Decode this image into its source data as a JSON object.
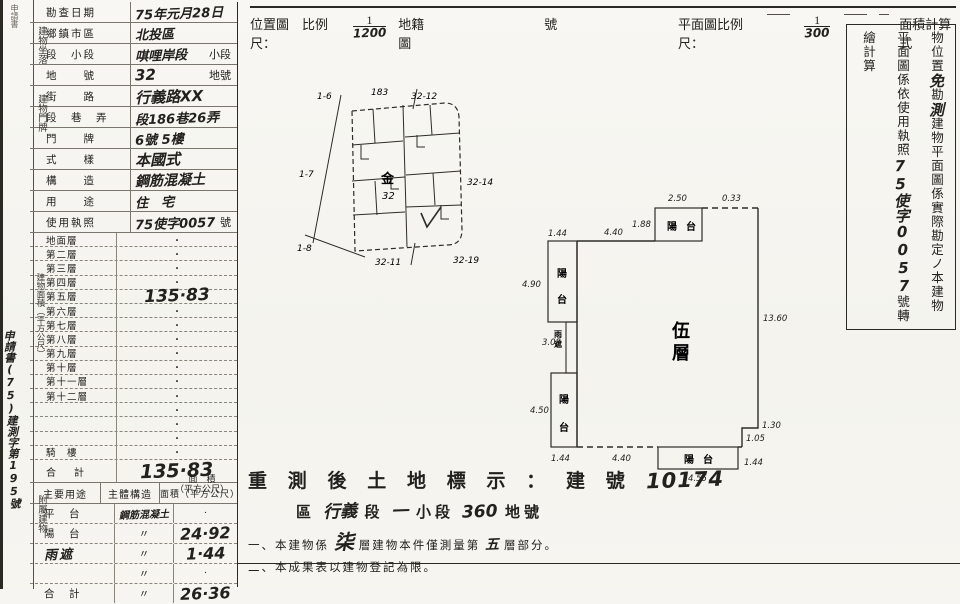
{
  "left_margin": {
    "top_label": "申請書",
    "doc_no": "申請書(75)建測字第195號"
  },
  "header": {
    "left_label": "位置圖　比例尺：",
    "left_num": "1",
    "left_den": "1200",
    "cadastral_label": "地籍圖",
    "cadastral_suffix": "號",
    "right_label": "平面圖比例尺：",
    "right_num": "1",
    "right_den": "300",
    "right_suffix": "面積計算式"
  },
  "info_rows": [
    {
      "label": "勘查日期",
      "value": "75年元月28日",
      "suffix": ""
    },
    {
      "label": "鄉鎮市區",
      "value": "北投區",
      "suffix": ""
    },
    {
      "label": "段　小段",
      "value": "唭哩岸段",
      "suffix": "小段"
    },
    {
      "label": "地　　號",
      "value": "32",
      "suffix": "地號"
    },
    {
      "label": "街　　路",
      "value": "行義路XX",
      "suffix": ""
    },
    {
      "label": "段　巷　弄",
      "value": "段186巷26弄",
      "suffix": ""
    },
    {
      "label": "門　　牌",
      "value": "6號 5樓",
      "suffix": ""
    },
    {
      "label": "式　　樣",
      "value": "本國式",
      "suffix": ""
    },
    {
      "label": "構　　造",
      "value": "鋼筋混凝土",
      "suffix": ""
    },
    {
      "label": "用　　途",
      "value": "住　宅",
      "suffix": ""
    },
    {
      "label": "使用執照",
      "value": "75使字0057",
      "suffix": "號"
    }
  ],
  "group_labels": {
    "location": "建物坐落",
    "address": "建物門牌",
    "area": "建物面積（平方公尺）",
    "attached": "附屬建物"
  },
  "floor_rows": [
    {
      "label": "地面層",
      "value": "·"
    },
    {
      "label": "第二層",
      "value": "·"
    },
    {
      "label": "第三層",
      "value": "·"
    },
    {
      "label": "第四層",
      "value": "·"
    },
    {
      "label": "第五層",
      "value": "135·83"
    },
    {
      "label": "第六層",
      "value": "·"
    },
    {
      "label": "第七層",
      "value": "·"
    },
    {
      "label": "第八層",
      "value": "·"
    },
    {
      "label": "第九層",
      "value": "·"
    },
    {
      "label": "第十層",
      "value": "·"
    },
    {
      "label": "第十一層",
      "value": "·"
    },
    {
      "label": "第十二層",
      "value": "·"
    },
    {
      "label": "",
      "value": "·"
    },
    {
      "label": "",
      "value": "·"
    },
    {
      "label": "",
      "value": "·"
    },
    {
      "label": "騎　樓",
      "value": "·"
    }
  ],
  "total_row": {
    "label": "合　計",
    "value": "135·83",
    "unit_line1": "面　積",
    "unit_line2": "（平方公尺）"
  },
  "attached_table": {
    "headers": {
      "use": "主要用途",
      "structure": "主體構造",
      "area": "面積（平方公尺）"
    },
    "rows": [
      {
        "use": "平　台",
        "structure": "鋼筋混凝土",
        "area": "·",
        "hw_use": false,
        "hw_struct": true,
        "hw_area": false
      },
      {
        "use": "陽　台",
        "structure": "〃",
        "area": "24·92",
        "hw_use": false,
        "hw_struct": false,
        "hw_area": true
      },
      {
        "use": "雨遮",
        "structure": "〃",
        "area": "1·44",
        "hw_use": true,
        "hw_struct": false,
        "hw_area": true
      },
      {
        "use": "",
        "structure": "〃",
        "area": "·",
        "hw_use": false,
        "hw_struct": false,
        "hw_area": false
      },
      {
        "use": "合　計",
        "structure": "〃",
        "area": "26·36",
        "hw_use": false,
        "hw_struct": false,
        "hw_area": true
      }
    ]
  },
  "notes_box": {
    "col1": "依實施建築改良物所有權第一次登記僅勘測建",
    "col2_pre": "物位置",
    "col2_hw1": "免",
    "col2_mid": "勘",
    "col2_hw2": "測",
    "col2_post": "建物平面圖係實際勘定ノ本建物",
    "col3_pre": "平面圖係依使用執照",
    "col3_hw": "75使字0057",
    "col3_post": "號轉繪計算"
  },
  "location_map": {
    "labels": {
      "tl": "1-6",
      "ml": "1-7",
      "bl": "1-8",
      "top": "183",
      "tr": "32-12",
      "right": "32-14",
      "bottom": "32-11",
      "br": "32-19",
      "center_char": "金",
      "center_num": "32"
    }
  },
  "floor_plan": {
    "main_label_1": "伍",
    "main_label_2": "層",
    "balcony_1": "陽",
    "balcony_2": "台",
    "canopy_1": "雨",
    "canopy_2": "遮",
    "dims": {
      "tl_w": "1.44",
      "tl_h": "4.90",
      "top": "4.40",
      "gap": "1.88",
      "tb_w": "2.50",
      "tr_seg": "0.33",
      "right": "13.60",
      "strip": "3.08",
      "ll_h": "4.50",
      "bl_w": "1.44",
      "bottom": "4.40",
      "bb_w": "4.55",
      "n1": "1.30",
      "n2": "1.05",
      "bb_h": "1.44"
    }
  },
  "bottom_text": {
    "title": "重 測 後 土 地 標 示 ： 建 號",
    "title_no": "10174",
    "line2_hw1": "行義",
    "line2_seg": "段",
    "line2_hw2": "一",
    "line2_small": "小段",
    "line2_hw3": "360",
    "line2_dihao": "地號",
    "line2_qu": "區",
    "note1_pre": "一、本建物係",
    "note1_hw1": "柒",
    "note1_mid": "層建物本件僅測量第",
    "note1_hw2": "五",
    "note1_post": "層部分。",
    "note2": "二、本成果表以建物登記為限。"
  }
}
